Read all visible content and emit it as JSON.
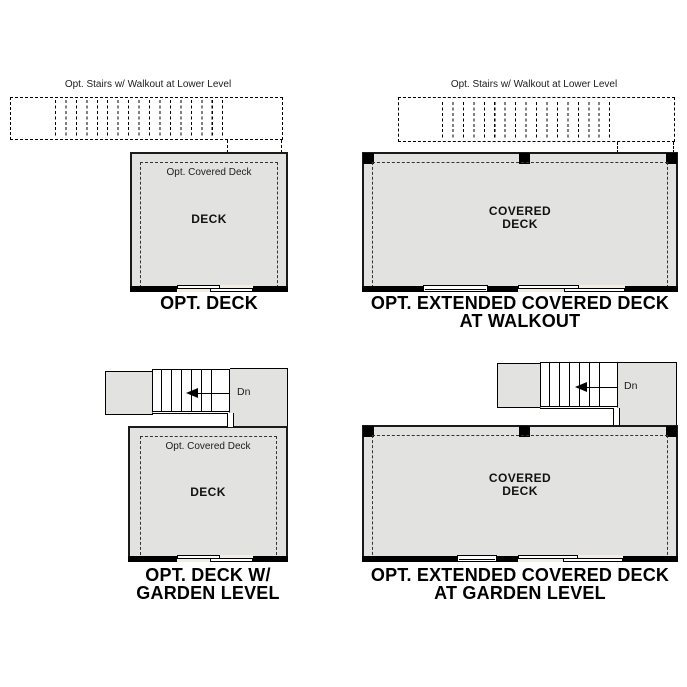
{
  "colors": {
    "deck_fill": "#e2e2e0",
    "door_fill": "#f1eee4",
    "line": "#000000",
    "wall": "#000000"
  },
  "figures": {
    "opt_deck": {
      "stairs_note": "Opt. Stairs w/ Walkout at Lower Level",
      "covered_note": "Opt. Covered Deck",
      "room": "DECK",
      "caption": [
        "OPT. DECK"
      ]
    },
    "extended_walkout": {
      "stairs_note": "Opt. Stairs w/ Walkout at Lower Level",
      "room": [
        "COVERED",
        "DECK"
      ],
      "caption": [
        "OPT. EXTENDED COVERED DECK",
        "AT WALKOUT"
      ]
    },
    "deck_garden": {
      "down_label": "Dn",
      "covered_note": "Opt. Covered Deck",
      "room": "DECK",
      "caption": [
        "OPT. DECK W/",
        "GARDEN LEVEL"
      ]
    },
    "extended_garden": {
      "down_label": "Dn",
      "room": [
        "COVERED",
        "DECK"
      ],
      "caption": [
        "OPT. EXTENDED COVERED DECK",
        "AT GARDEN LEVEL"
      ]
    }
  }
}
